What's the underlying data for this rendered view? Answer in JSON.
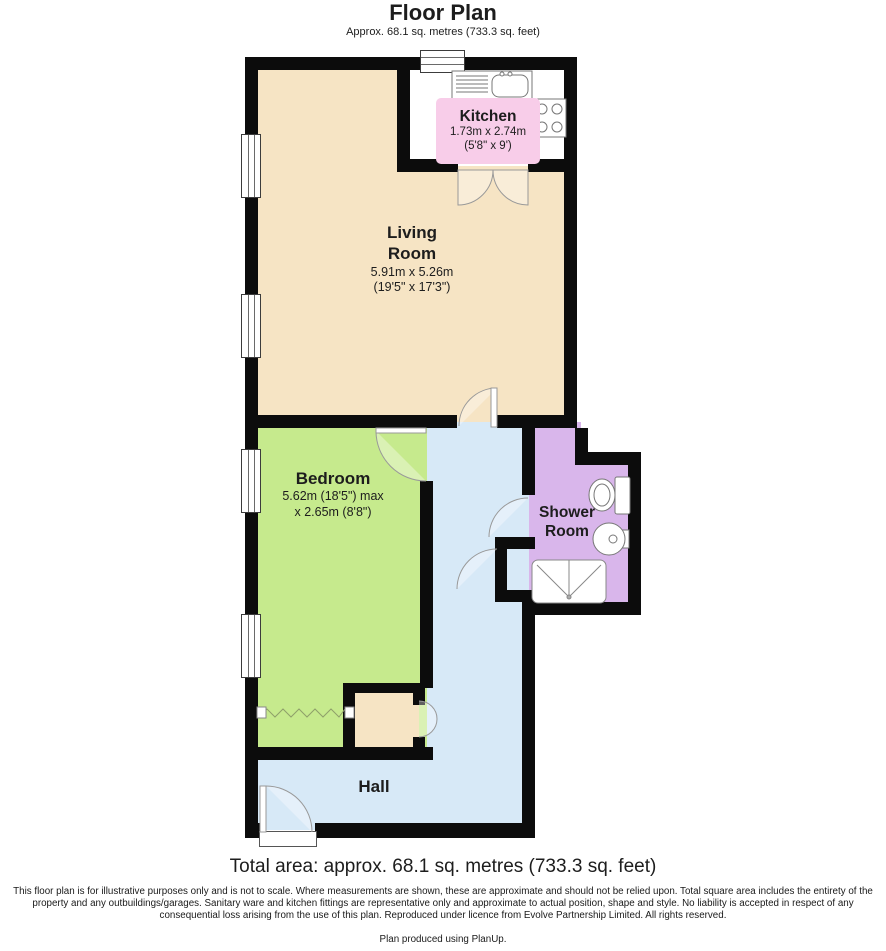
{
  "header": {
    "title": "Floor Plan",
    "subtitle": "Approx. 68.1 sq. metres (733.3 sq. feet)"
  },
  "rooms": {
    "kitchen": {
      "name": "Kitchen",
      "dims_metric": "1.73m x 2.74m",
      "dims_imperial": "(5'8\" x 9')",
      "label_color": "#F8CDE9",
      "floor_color": "#FFFFFF"
    },
    "living_room": {
      "name_line1": "Living",
      "name_line2": "Room",
      "dims_metric": "5.91m x 5.26m",
      "dims_imperial": "(19'5\" x 17'3\")",
      "floor_color": "#F6E4C4"
    },
    "bedroom": {
      "name": "Bedroom",
      "dims_line1": "5.62m (18'5\") max",
      "dims_line2": "x 2.65m (8'8\")",
      "floor_color": "#C6EA8D"
    },
    "shower_room": {
      "name_line1": "Shower",
      "name_line2": "Room",
      "floor_color": "#D9B6EB"
    },
    "hall": {
      "name": "Hall",
      "floor_color": "#D7E9F7"
    }
  },
  "colors": {
    "wall": "#0C0C0C",
    "door_arc": "#999999",
    "fixture_outline": "#777777"
  },
  "footer": {
    "total_area": "Total area: approx. 68.1 sq. metres (733.3 sq. feet)",
    "disclaimer": "This floor plan is for illustrative purposes only and is not to scale.  Where measurements are shown, these are approximate and should not be relied upon. Total square area includes the entirety of the property and any outbuildings/garages. Sanitary ware and kitchen fittings are representative only and approximate to actual position, shape and style.  No liability is accepted in respect of any consequential loss arising from the use of this plan. Reproduced under licence from Evolve Partnership Limited. All rights reserved.",
    "produced": "Plan produced using PlanUp."
  }
}
